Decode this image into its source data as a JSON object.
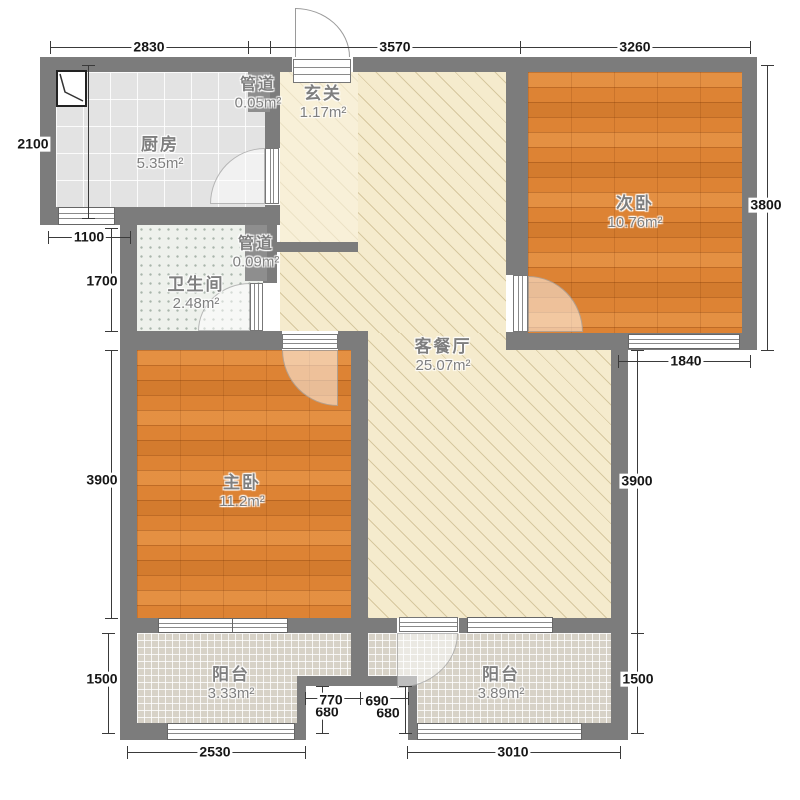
{
  "rooms": {
    "kitchen": {
      "name": "厨房",
      "area": "5.35m²"
    },
    "duct_top": {
      "name": "管道",
      "area": "0.05m²"
    },
    "hallway": {
      "name": "玄关",
      "area": "1.17m²"
    },
    "bedroom2": {
      "name": "次卧",
      "area": "10.76m²"
    },
    "bathroom": {
      "name": "卫生间",
      "area": "2.48m²"
    },
    "duct_mid": {
      "name": "管道",
      "area": "0.09m²"
    },
    "living": {
      "name": "客餐厅",
      "area": "25.07m²"
    },
    "bedroom1": {
      "name": "主卧",
      "area": "11.2m²"
    },
    "balcony_left": {
      "name": "阳台",
      "area": "3.33m²"
    },
    "balcony_right": {
      "name": "阳台",
      "area": "3.89m²"
    }
  },
  "dims": {
    "top": [
      "2830",
      "3570",
      "3260"
    ],
    "left": [
      "2100",
      "1100",
      "1700",
      "3900",
      "1500"
    ],
    "right": [
      "3800",
      "1840",
      "3900",
      "1500"
    ],
    "bottom": [
      "2530",
      "3010"
    ],
    "recess": [
      "770",
      "690",
      "680",
      "680"
    ]
  },
  "colors": {
    "wall": "#7c7c7c",
    "wood_floor": "#dd8334",
    "living_floor": "#f5ebcd",
    "kitchen_floor": "#e3e3e3",
    "bath_floor": "#eef1ec",
    "balcony_floor": "#d7d2c7"
  }
}
